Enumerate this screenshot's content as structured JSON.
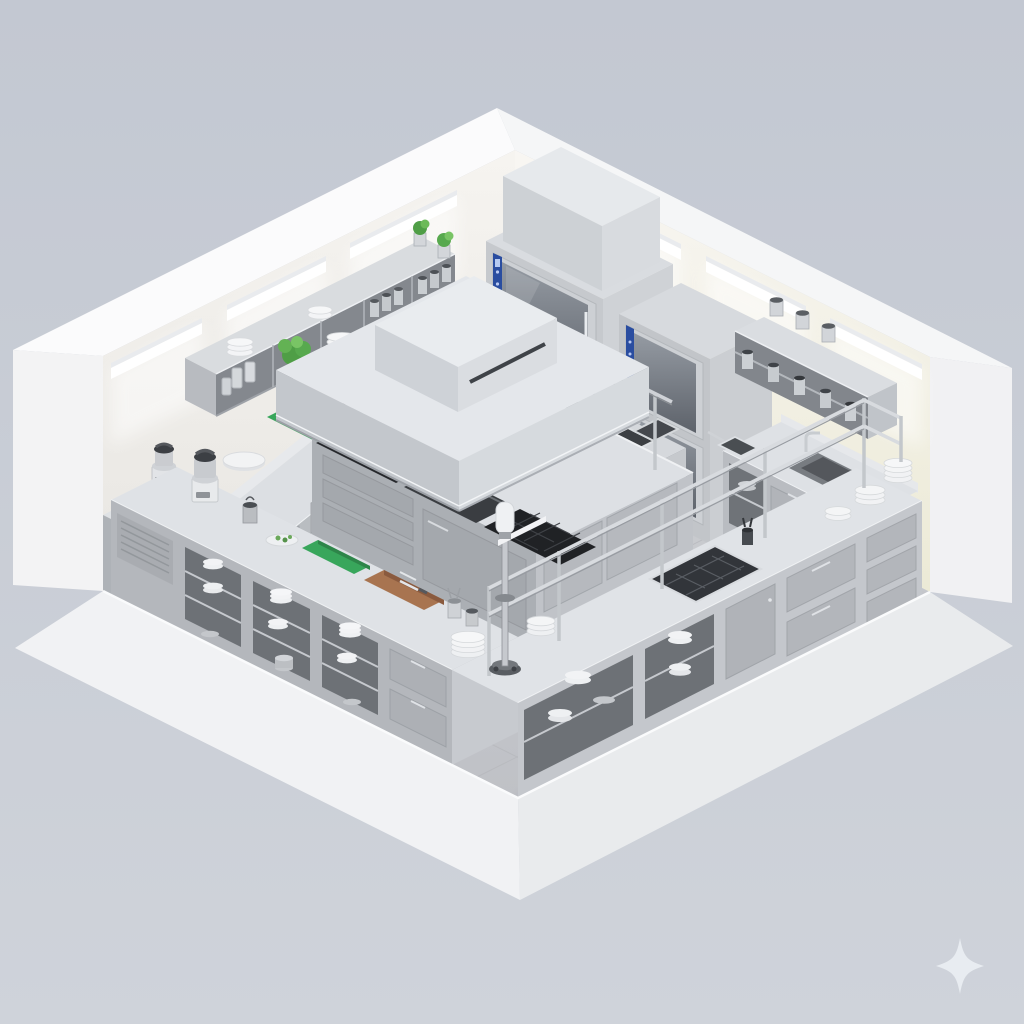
{
  "scene": {
    "title": "Isometric 3D render of a commercial stainless-steel kitchen",
    "description": "Cutaway isometric room with two white walls, recessed linear LED light strips, grey tiled floor, stainless counters around the perimeter, a central cooking island under a large extraction hood, stacked combi ovens, wall shelves with plates, jars and fresh greens, and an L-shaped front pass counter.",
    "room": {
      "wall_color": "#f2f0ec",
      "floor_tile_color": "#c7c9cd",
      "light_strips_left_wall": 3,
      "light_strips_right_wall": 3
    },
    "palette": {
      "background": "#c6cad4",
      "wall_white": "#f4f2ee",
      "plinth_white": "#f0f1f3",
      "steel_top": "#dfe2e6",
      "steel_face_light": "#c7cacf",
      "steel_face_dark": "#b2b5ba",
      "dark_cooktop": "#26282c",
      "oven_panel_blue": "#2a4da0",
      "cutting_board_green": "#38a65b",
      "cutting_board_wood": "#a87450",
      "lettuce_green": "#57a94e",
      "tomato_red": "#c0443c",
      "sparkle_white": "#e9edf2"
    },
    "stations": {
      "room_shell": {
        "label": "White room shell with recessed LED light strips"
      },
      "floor": {
        "label": "Grey tiled kitchen floor"
      },
      "left_wall_shelf": {
        "label": "Wall shelf with plates, glass jars, spice tins, lettuce and herb pots"
      },
      "left_wall_counter": {
        "label": "Back-left counter with drawers, green cutting board, round board and cherry tomatoes"
      },
      "prep_block": {
        "label": "Low prep block with food processor"
      },
      "combi_oven_stack_1": {
        "label": "Double stacked combi oven with blue control panels and exhaust plenum"
      },
      "combi_oven_stack_2": {
        "label": "Second stacked combi oven"
      },
      "fryer_station": {
        "label": "Deep fryer with twin baskets"
      },
      "right_wall_shelf": {
        "label": "Wall shelf with steel canisters"
      },
      "right_wall_counter": {
        "label": "Right-wall counter with inset sink, fry baskets and drawers"
      },
      "cooking_island": {
        "label": "Central cooking island with induction hob, griddle, gas burners and ovens"
      },
      "extraction_hood": {
        "label": "Large stainless extraction hood with exhaust box"
      },
      "pot_rack": {
        "label": "Hanging pot rack with pans"
      },
      "front_left_counter": {
        "label": "Front prep counter with food processor, boards, knives and under-shelf plates"
      },
      "front_right_counter": {
        "label": "Front pass counter with gantry rails, inset gas hob and plate stacks"
      },
      "mixer_stand": {
        "label": "Column stand mixer at the pass corner"
      }
    },
    "icons": {
      "sparkle": {
        "name": "sparkle-icon",
        "color": "#e9edf2"
      }
    }
  }
}
